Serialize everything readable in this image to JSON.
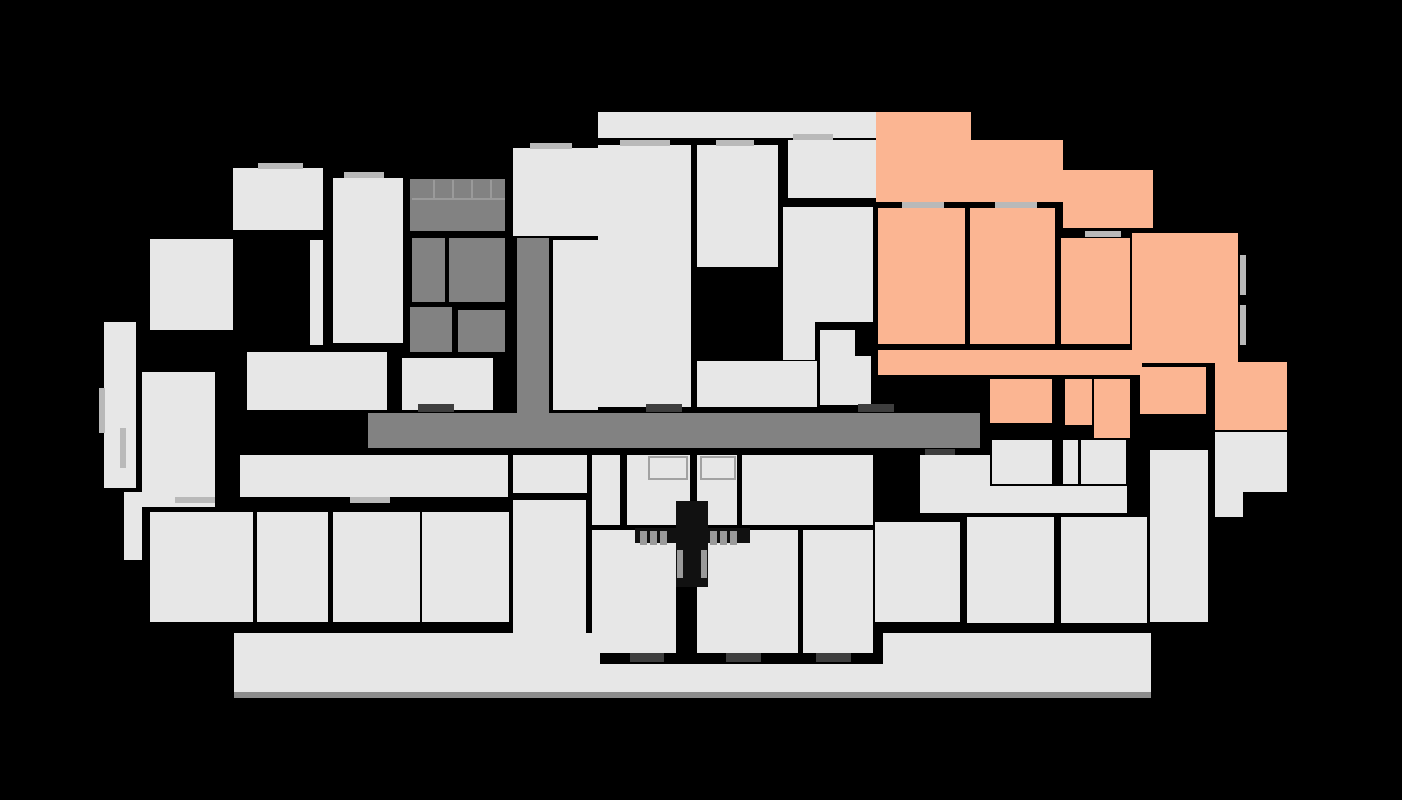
{
  "canvas": {
    "width": 1402,
    "height": 800,
    "background": "#000000"
  },
  "palette": {
    "room": "#e7e7e7",
    "core": "#828282",
    "highlight": "#fbb592",
    "sill": "#b9b9b9",
    "door": "#3e3e3e",
    "shadow": "#8c8c8c",
    "tread": "#9a9a9a",
    "black": "#111111",
    "closet_border": "#a2a2a2"
  },
  "shapes": [
    {
      "name": "corridor-main",
      "x": 368,
      "y": 413,
      "w": 612,
      "h": 35,
      "fill": "core",
      "interactable": false
    },
    {
      "name": "corridor-stem",
      "x": 517,
      "y": 238,
      "w": 32,
      "h": 177,
      "fill": "core",
      "interactable": false
    },
    {
      "name": "stair-core-room",
      "x": 410,
      "y": 179,
      "w": 95,
      "h": 52,
      "fill": "core",
      "interactable": false
    },
    {
      "name": "core-room",
      "x": 412,
      "y": 238,
      "w": 33,
      "h": 64,
      "fill": "core",
      "interactable": false
    },
    {
      "name": "core-room",
      "x": 449,
      "y": 238,
      "w": 56,
      "h": 64,
      "fill": "core",
      "interactable": false
    },
    {
      "name": "core-room",
      "x": 410,
      "y": 307,
      "w": 42,
      "h": 45,
      "fill": "core",
      "interactable": false
    },
    {
      "name": "core-room",
      "x": 458,
      "y": 310,
      "w": 47,
      "h": 42,
      "fill": "core",
      "interactable": false
    },
    {
      "name": "unit-room",
      "x": 233,
      "y": 168,
      "w": 90,
      "h": 62,
      "fill": "room",
      "interactable": false
    },
    {
      "name": "unit-room",
      "x": 310,
      "y": 240,
      "w": 13,
      "h": 105,
      "fill": "room",
      "interactable": false
    },
    {
      "name": "unit-room",
      "x": 333,
      "y": 178,
      "w": 70,
      "h": 165,
      "fill": "room",
      "interactable": false
    },
    {
      "name": "unit-room",
      "x": 150,
      "y": 239,
      "w": 83,
      "h": 91,
      "fill": "room",
      "interactable": false
    },
    {
      "name": "balcony-left",
      "x": 104,
      "y": 322,
      "w": 32,
      "h": 166,
      "fill": "room",
      "interactable": false
    },
    {
      "name": "unit-room",
      "x": 142,
      "y": 372,
      "w": 73,
      "h": 33,
      "fill": "room",
      "interactable": false
    },
    {
      "name": "unit-room",
      "x": 142,
      "y": 405,
      "w": 73,
      "h": 102,
      "fill": "room",
      "interactable": false
    },
    {
      "name": "balcony-left",
      "x": 124,
      "y": 492,
      "w": 18,
      "h": 68,
      "fill": "room",
      "interactable": false
    },
    {
      "name": "unit-hall",
      "x": 247,
      "y": 352,
      "w": 140,
      "h": 58,
      "fill": "room",
      "interactable": false
    },
    {
      "name": "unit-hall",
      "x": 402,
      "y": 358,
      "w": 91,
      "h": 52,
      "fill": "room",
      "interactable": false
    },
    {
      "name": "unit-room",
      "x": 553,
      "y": 240,
      "w": 45,
      "h": 170,
      "fill": "room",
      "interactable": false
    },
    {
      "name": "unit-room",
      "x": 513,
      "y": 148,
      "w": 87,
      "h": 88,
      "fill": "room",
      "interactable": false
    },
    {
      "name": "terrace-strip",
      "x": 598,
      "y": 112,
      "w": 278,
      "h": 26,
      "fill": "room",
      "interactable": false
    },
    {
      "name": "unit-room",
      "x": 598,
      "y": 145,
      "w": 93,
      "h": 262,
      "fill": "room",
      "interactable": false
    },
    {
      "name": "unit-room",
      "x": 697,
      "y": 145,
      "w": 81,
      "h": 122,
      "fill": "room",
      "interactable": false
    },
    {
      "name": "unit-hall",
      "x": 788,
      "y": 140,
      "w": 88,
      "h": 58,
      "fill": "room",
      "interactable": false
    },
    {
      "name": "unit-room",
      "x": 783,
      "y": 207,
      "w": 90,
      "h": 115,
      "fill": "room",
      "interactable": false
    },
    {
      "name": "unit-room",
      "x": 783,
      "y": 322,
      "w": 32,
      "h": 38,
      "fill": "room",
      "interactable": false
    },
    {
      "name": "unit-room",
      "x": 820,
      "y": 330,
      "w": 35,
      "h": 26,
      "fill": "room",
      "interactable": false
    },
    {
      "name": "unit-room",
      "x": 820,
      "y": 356,
      "w": 51,
      "h": 49,
      "fill": "room",
      "interactable": false
    },
    {
      "name": "unit-room",
      "x": 697,
      "y": 361,
      "w": 120,
      "h": 46,
      "fill": "room",
      "interactable": false
    },
    {
      "name": "unit-hall",
      "x": 920,
      "y": 455,
      "w": 70,
      "h": 33,
      "fill": "room",
      "interactable": false
    },
    {
      "name": "unit-hall",
      "x": 920,
      "y": 486,
      "w": 207,
      "h": 27,
      "fill": "room",
      "interactable": false
    },
    {
      "name": "unit-room",
      "x": 992,
      "y": 440,
      "w": 60,
      "h": 44,
      "fill": "room",
      "interactable": false
    },
    {
      "name": "unit-room",
      "x": 1063,
      "y": 440,
      "w": 15,
      "h": 44,
      "fill": "room",
      "interactable": false
    },
    {
      "name": "unit-room",
      "x": 1081,
      "y": 440,
      "w": 45,
      "h": 44,
      "fill": "room",
      "interactable": false
    },
    {
      "name": "unit-room",
      "x": 875,
      "y": 522,
      "w": 85,
      "h": 100,
      "fill": "room",
      "interactable": false
    },
    {
      "name": "unit-room",
      "x": 967,
      "y": 517,
      "w": 87,
      "h": 106,
      "fill": "room",
      "interactable": false
    },
    {
      "name": "unit-room",
      "x": 1061,
      "y": 517,
      "w": 86,
      "h": 106,
      "fill": "room",
      "interactable": false
    },
    {
      "name": "unit-room",
      "x": 1150,
      "y": 450,
      "w": 58,
      "h": 172,
      "fill": "room",
      "interactable": false
    },
    {
      "name": "unit-room",
      "x": 513,
      "y": 455,
      "w": 74,
      "h": 38,
      "fill": "room",
      "interactable": false
    },
    {
      "name": "unit-room",
      "x": 592,
      "y": 455,
      "w": 28,
      "h": 70,
      "fill": "room",
      "interactable": false
    },
    {
      "name": "unit-room",
      "x": 627,
      "y": 455,
      "w": 63,
      "h": 70,
      "fill": "room",
      "interactable": false
    },
    {
      "name": "unit-room",
      "x": 697,
      "y": 455,
      "w": 40,
      "h": 70,
      "fill": "room",
      "interactable": false
    },
    {
      "name": "unit-room",
      "x": 742,
      "y": 455,
      "w": 131,
      "h": 70,
      "fill": "room",
      "interactable": false
    },
    {
      "name": "unit-room",
      "x": 513,
      "y": 500,
      "w": 73,
      "h": 153,
      "fill": "room",
      "interactable": false
    },
    {
      "name": "unit-room",
      "x": 592,
      "y": 530,
      "w": 84,
      "h": 123,
      "fill": "room",
      "interactable": false
    },
    {
      "name": "unit-room",
      "x": 697,
      "y": 530,
      "w": 101,
      "h": 123,
      "fill": "room",
      "interactable": false
    },
    {
      "name": "unit-room",
      "x": 803,
      "y": 530,
      "w": 70,
      "h": 123,
      "fill": "room",
      "interactable": false
    },
    {
      "name": "unit-hall",
      "x": 240,
      "y": 455,
      "w": 268,
      "h": 42,
      "fill": "room",
      "interactable": false
    },
    {
      "name": "unit-room",
      "x": 150,
      "y": 512,
      "w": 103,
      "h": 110,
      "fill": "room",
      "interactable": false
    },
    {
      "name": "unit-room",
      "x": 257,
      "y": 512,
      "w": 71,
      "h": 110,
      "fill": "room",
      "interactable": false
    },
    {
      "name": "unit-room",
      "x": 333,
      "y": 512,
      "w": 87,
      "h": 110,
      "fill": "room",
      "interactable": false
    },
    {
      "name": "unit-room",
      "x": 422,
      "y": 512,
      "w": 87,
      "h": 110,
      "fill": "room",
      "interactable": false
    },
    {
      "name": "balcony-strip",
      "x": 234,
      "y": 633,
      "w": 366,
      "h": 59,
      "fill": "room",
      "interactable": false
    },
    {
      "name": "balcony-strip",
      "x": 600,
      "y": 664,
      "w": 283,
      "h": 28,
      "fill": "room",
      "interactable": false
    },
    {
      "name": "balcony-strip",
      "x": 883,
      "y": 633,
      "w": 268,
      "h": 59,
      "fill": "room",
      "interactable": false
    },
    {
      "name": "plan-shadow",
      "x": 234,
      "y": 692,
      "w": 917,
      "h": 6,
      "fill": "shadow",
      "interactable": false
    },
    {
      "name": "unit-room",
      "x": 1215,
      "y": 432,
      "w": 72,
      "h": 60,
      "fill": "room",
      "interactable": false
    },
    {
      "name": "unit-room",
      "x": 1215,
      "y": 492,
      "w": 28,
      "h": 25,
      "fill": "room",
      "interactable": false
    },
    {
      "name": "highlighted-unit-room",
      "x": 876,
      "y": 112,
      "w": 95,
      "h": 90,
      "fill": "highlight",
      "interactable": true
    },
    {
      "name": "highlighted-unit-room",
      "x": 971,
      "y": 140,
      "w": 92,
      "h": 62,
      "fill": "highlight",
      "interactable": true
    },
    {
      "name": "highlighted-unit-room",
      "x": 1063,
      "y": 170,
      "w": 90,
      "h": 58,
      "fill": "highlight",
      "interactable": true
    },
    {
      "name": "highlighted-unit-room",
      "x": 878,
      "y": 208,
      "w": 87,
      "h": 136,
      "fill": "highlight",
      "interactable": true
    },
    {
      "name": "highlighted-unit-room",
      "x": 970,
      "y": 208,
      "w": 85,
      "h": 136,
      "fill": "highlight",
      "interactable": true
    },
    {
      "name": "highlighted-unit-room",
      "x": 1061,
      "y": 238,
      "w": 69,
      "h": 106,
      "fill": "highlight",
      "interactable": true
    },
    {
      "name": "highlighted-unit-room",
      "x": 1132,
      "y": 233,
      "w": 106,
      "h": 130,
      "fill": "highlight",
      "interactable": true
    },
    {
      "name": "highlighted-unit-hall",
      "x": 878,
      "y": 350,
      "w": 264,
      "h": 25,
      "fill": "highlight",
      "interactable": true
    },
    {
      "name": "highlighted-unit-room",
      "x": 990,
      "y": 379,
      "w": 62,
      "h": 44,
      "fill": "highlight",
      "interactable": true
    },
    {
      "name": "highlighted-unit-room",
      "x": 1065,
      "y": 379,
      "w": 27,
      "h": 46,
      "fill": "highlight",
      "interactable": true
    },
    {
      "name": "highlighted-unit-room",
      "x": 1094,
      "y": 379,
      "w": 36,
      "h": 59,
      "fill": "highlight",
      "interactable": true
    },
    {
      "name": "highlighted-unit-room",
      "x": 1140,
      "y": 367,
      "w": 66,
      "h": 47,
      "fill": "highlight",
      "interactable": true
    },
    {
      "name": "highlighted-unit-room",
      "x": 1215,
      "y": 362,
      "w": 72,
      "h": 68,
      "fill": "highlight",
      "interactable": true
    },
    {
      "name": "stair-tread",
      "x": 433,
      "y": 180,
      "w": 2,
      "h": 19,
      "fill": "tread",
      "interactable": false
    },
    {
      "name": "stair-tread",
      "x": 452,
      "y": 180,
      "w": 2,
      "h": 19,
      "fill": "tread",
      "interactable": false
    },
    {
      "name": "stair-tread",
      "x": 471,
      "y": 180,
      "w": 2,
      "h": 19,
      "fill": "tread",
      "interactable": false
    },
    {
      "name": "stair-tread",
      "x": 490,
      "y": 180,
      "w": 2,
      "h": 19,
      "fill": "tread",
      "interactable": false
    },
    {
      "name": "stair-tread",
      "x": 412,
      "y": 198,
      "w": 93,
      "h": 2,
      "fill": "tread",
      "interactable": false
    },
    {
      "name": "closet-outline",
      "x": 648,
      "y": 456,
      "w": 40,
      "h": 24,
      "fill": "room",
      "interactable": false,
      "border": true
    },
    {
      "name": "closet-outline",
      "x": 700,
      "y": 456,
      "w": 36,
      "h": 24,
      "fill": "room",
      "interactable": false,
      "border": true
    },
    {
      "name": "stairwell-shaft",
      "x": 676,
      "y": 501,
      "w": 32,
      "h": 86,
      "fill": "black",
      "interactable": false
    },
    {
      "name": "stairwell-landing",
      "x": 635,
      "y": 528,
      "w": 115,
      "h": 15,
      "fill": "black",
      "interactable": false
    },
    {
      "name": "stair-tread",
      "x": 640,
      "y": 531,
      "w": 7,
      "h": 14,
      "fill": "tread",
      "interactable": false
    },
    {
      "name": "stair-tread",
      "x": 650,
      "y": 531,
      "w": 7,
      "h": 14,
      "fill": "tread",
      "interactable": false
    },
    {
      "name": "stair-tread",
      "x": 660,
      "y": 531,
      "w": 7,
      "h": 14,
      "fill": "tread",
      "interactable": false
    },
    {
      "name": "stair-tread",
      "x": 710,
      "y": 531,
      "w": 7,
      "h": 14,
      "fill": "tread",
      "interactable": false
    },
    {
      "name": "stair-tread",
      "x": 720,
      "y": 531,
      "w": 7,
      "h": 14,
      "fill": "tread",
      "interactable": false
    },
    {
      "name": "stair-tread",
      "x": 730,
      "y": 531,
      "w": 7,
      "h": 14,
      "fill": "tread",
      "interactable": false
    },
    {
      "name": "stair-tread",
      "x": 677,
      "y": 550,
      "w": 6,
      "h": 28,
      "fill": "tread",
      "interactable": false
    },
    {
      "name": "stair-tread",
      "x": 701,
      "y": 550,
      "w": 6,
      "h": 28,
      "fill": "tread",
      "interactable": false
    },
    {
      "name": "window-sill",
      "x": 258,
      "y": 163,
      "w": 45,
      "h": 6,
      "fill": "sill",
      "interactable": false
    },
    {
      "name": "window-sill",
      "x": 344,
      "y": 172,
      "w": 40,
      "h": 6,
      "fill": "sill",
      "interactable": false
    },
    {
      "name": "window-sill",
      "x": 530,
      "y": 143,
      "w": 42,
      "h": 6,
      "fill": "sill",
      "interactable": false
    },
    {
      "name": "window-sill",
      "x": 620,
      "y": 140,
      "w": 50,
      "h": 6,
      "fill": "sill",
      "interactable": false
    },
    {
      "name": "window-sill",
      "x": 716,
      "y": 140,
      "w": 38,
      "h": 6,
      "fill": "sill",
      "interactable": false
    },
    {
      "name": "window-sill",
      "x": 793,
      "y": 134,
      "w": 40,
      "h": 6,
      "fill": "sill",
      "interactable": false
    },
    {
      "name": "window-sill",
      "x": 902,
      "y": 202,
      "w": 42,
      "h": 6,
      "fill": "sill",
      "interactable": false
    },
    {
      "name": "window-sill",
      "x": 995,
      "y": 202,
      "w": 42,
      "h": 6,
      "fill": "sill",
      "interactable": false
    },
    {
      "name": "window-sill",
      "x": 1085,
      "y": 231,
      "w": 36,
      "h": 6,
      "fill": "sill",
      "interactable": false
    },
    {
      "name": "window-sill",
      "x": 1240,
      "y": 255,
      "w": 6,
      "h": 40,
      "fill": "sill",
      "interactable": false
    },
    {
      "name": "window-sill",
      "x": 1240,
      "y": 305,
      "w": 6,
      "h": 40,
      "fill": "sill",
      "interactable": false
    },
    {
      "name": "window-sill",
      "x": 99,
      "y": 388,
      "w": 6,
      "h": 45,
      "fill": "sill",
      "interactable": false
    },
    {
      "name": "window-sill",
      "x": 120,
      "y": 428,
      "w": 6,
      "h": 40,
      "fill": "sill",
      "interactable": false
    },
    {
      "name": "window-sill",
      "x": 175,
      "y": 497,
      "w": 40,
      "h": 6,
      "fill": "sill",
      "interactable": false
    },
    {
      "name": "window-sill",
      "x": 350,
      "y": 497,
      "w": 40,
      "h": 6,
      "fill": "sill",
      "interactable": false
    },
    {
      "name": "door-threshold",
      "x": 418,
      "y": 404,
      "w": 36,
      "h": 8,
      "fill": "door",
      "interactable": false
    },
    {
      "name": "door-threshold",
      "x": 646,
      "y": 404,
      "w": 36,
      "h": 8,
      "fill": "door",
      "interactable": false
    },
    {
      "name": "door-threshold",
      "x": 858,
      "y": 404,
      "w": 36,
      "h": 8,
      "fill": "door",
      "interactable": false
    },
    {
      "name": "door-threshold",
      "x": 925,
      "y": 449,
      "w": 30,
      "h": 6,
      "fill": "door",
      "interactable": false
    },
    {
      "name": "door-threshold",
      "x": 630,
      "y": 653,
      "w": 34,
      "h": 9,
      "fill": "door",
      "interactable": false
    },
    {
      "name": "door-threshold",
      "x": 726,
      "y": 653,
      "w": 35,
      "h": 9,
      "fill": "door",
      "interactable": false
    },
    {
      "name": "door-threshold",
      "x": 816,
      "y": 653,
      "w": 35,
      "h": 9,
      "fill": "door",
      "interactable": false
    }
  ]
}
